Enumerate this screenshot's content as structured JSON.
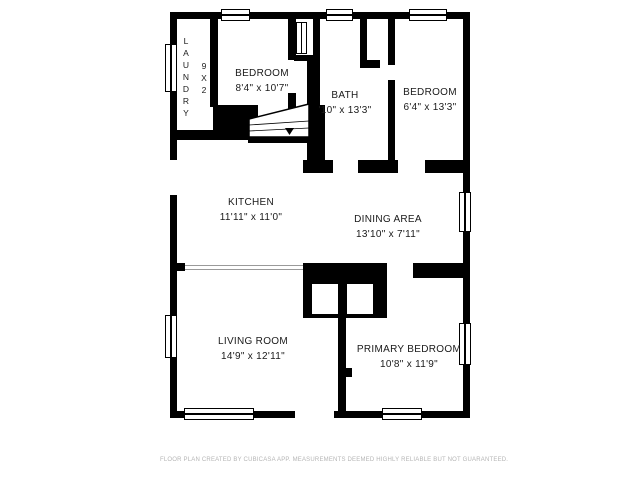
{
  "plan": {
    "rooms": {
      "laundry": {
        "name": "LAUNDRY",
        "dims": "9X2"
      },
      "bedroom_top_left": {
        "name": "BEDROOM",
        "dims": "8'4\" x 10'7\""
      },
      "bath": {
        "name": "BATH",
        "dims": "'10\" x 13'3\""
      },
      "bedroom_top_right": {
        "name": "BEDROOM",
        "dims": "6'4\" x 13'3\""
      },
      "kitchen": {
        "name": "KITCHEN",
        "dims": "11'11\" x 11'0\""
      },
      "dining_area": {
        "name": "DINING AREA",
        "dims": "13'10\" x 7'11\""
      },
      "living_room": {
        "name": "LIVING ROOM",
        "dims": "14'9\" x 12'11\""
      },
      "primary_bedroom": {
        "name": "PRIMARY BEDROOM",
        "dims": "10'8\" x 11'9\""
      }
    },
    "footer": {
      "disclaimer": "FLOOR PLAN CREATED BY CUBICASA APP. MEASUREMENTS DEEMED HIGHLY RELIABLE BUT NOT GUARANTEED."
    },
    "colors": {
      "wall": "#000000",
      "label_text": "#1a1a1a",
      "disclaimer_text": "#b5b5b5",
      "background": "#ffffff"
    }
  }
}
